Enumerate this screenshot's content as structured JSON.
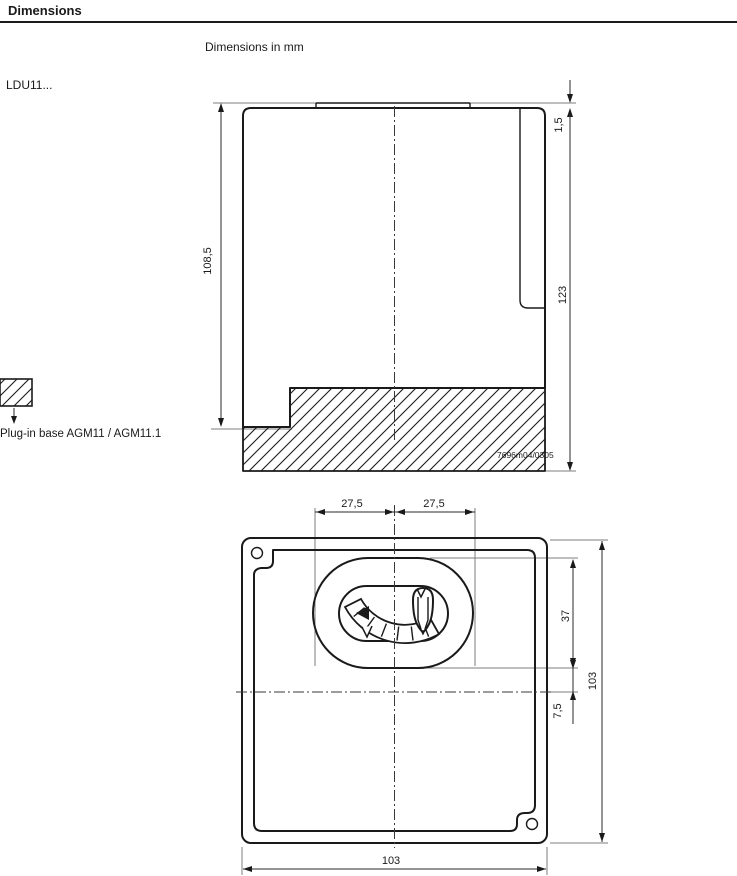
{
  "header": {
    "title": "Dimensions",
    "units_note": "Dimensions in mm"
  },
  "side_view": {
    "model_label": "LDU11...",
    "legend_label": "Plug-in base AGM11 / AGM11.1",
    "ref_number": "7696m04/0305",
    "dimensions": {
      "front_height": "108,5",
      "top_step": "1,5",
      "total_height": "123"
    }
  },
  "front_view": {
    "dimensions": {
      "left_half_width": "27,5",
      "right_half_width": "27,5",
      "window_height": "37",
      "center_offset": "7,5",
      "total_height": "103",
      "total_width": "103"
    }
  },
  "icons": {
    "hatch_swatch": "diagonal-hatch-pattern",
    "down_arrow": "↓"
  },
  "colors": {
    "line": "#1a1a1a",
    "dim_line": "#2a2a2a",
    "extension_line": "#7d7d7d",
    "background": "#ffffff"
  }
}
